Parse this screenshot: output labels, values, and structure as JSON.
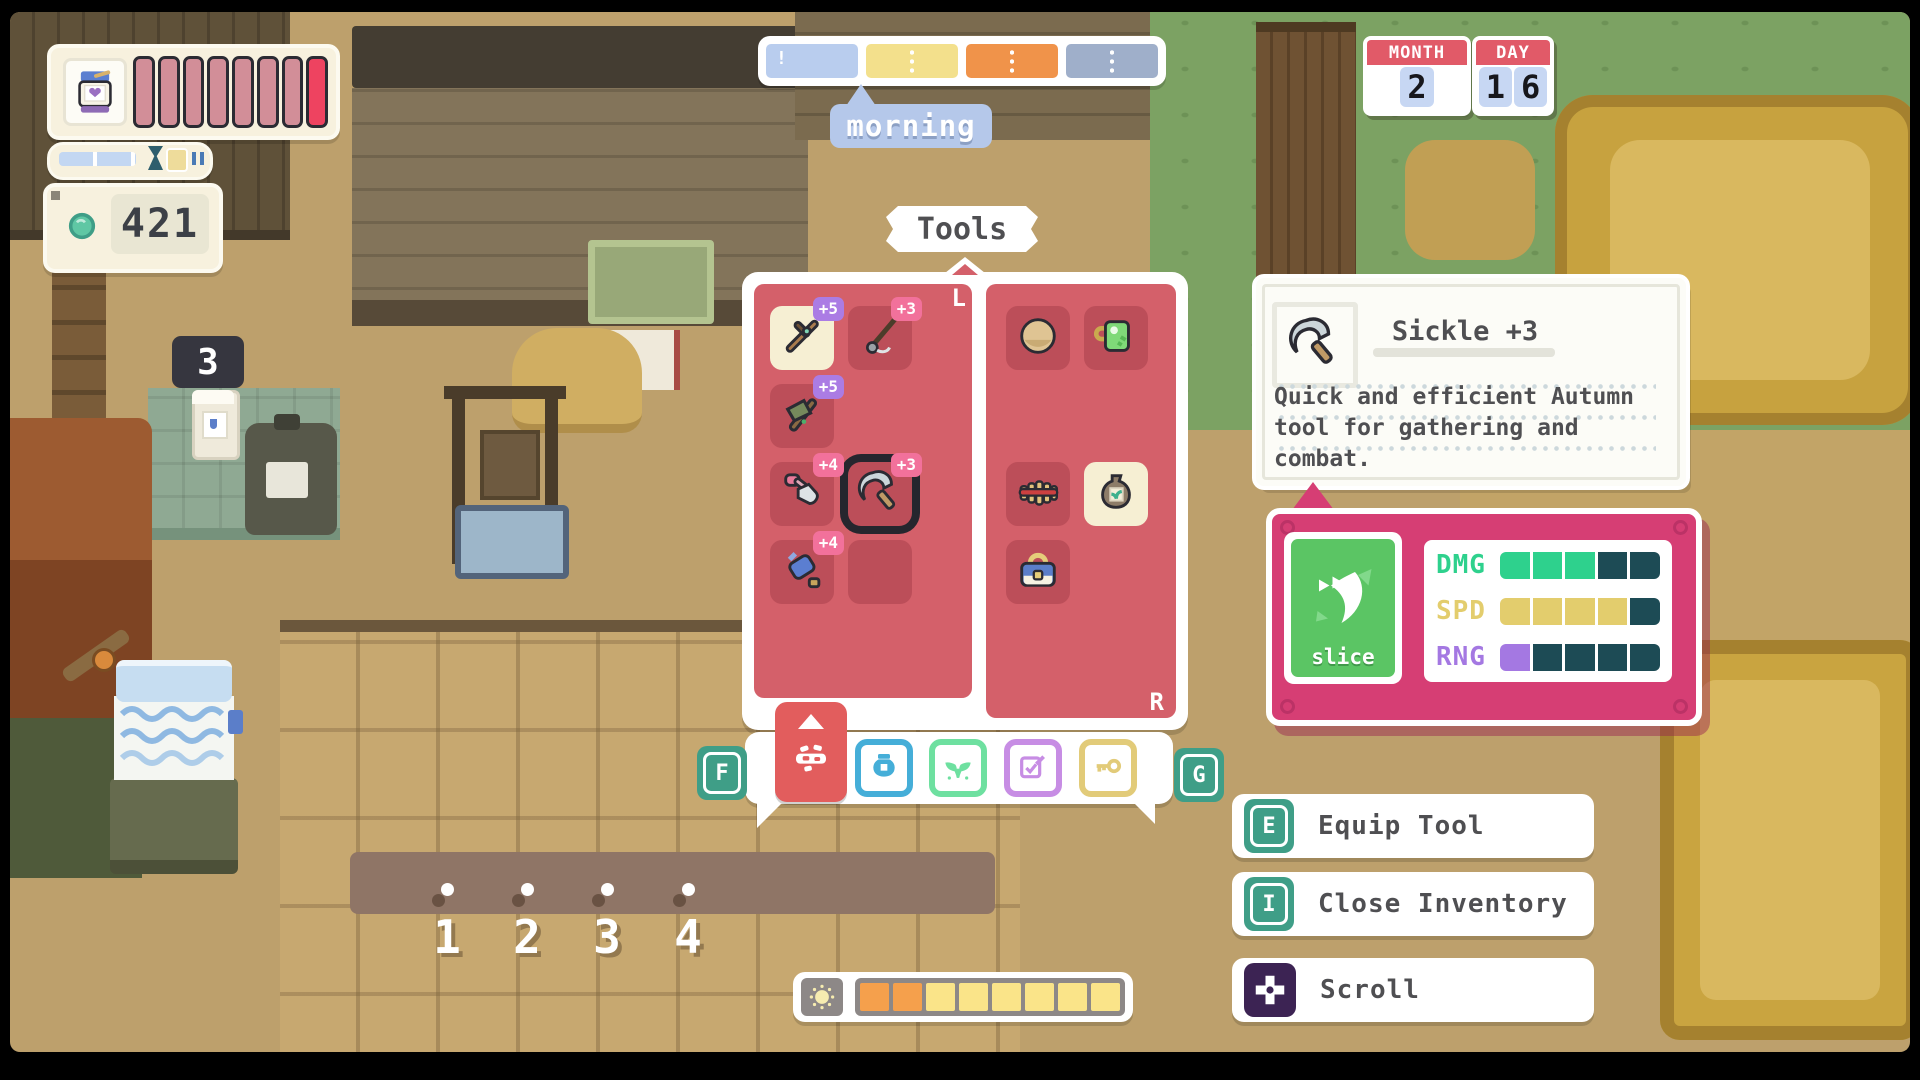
{
  "palette": {
    "panel_red": "#d4606a",
    "slot_red": "#bc4e59",
    "stats_magenta": "#d63e74",
    "card_green": "#5bc564",
    "key_teal": "#3f9e87",
    "health_dim": "#d28e98",
    "health_bright": "#ee4360"
  },
  "hud": {
    "health": {
      "total": 8,
      "dim": 7,
      "bright": 1
    },
    "xp_fill_pct": 55,
    "money": "421"
  },
  "time": {
    "label": "morning",
    "segments": [
      {
        "id": "dawn",
        "color": "#b9cdee"
      },
      {
        "id": "morning",
        "color": "#f3e08c"
      },
      {
        "id": "afternoon",
        "color": "#f0934a"
      },
      {
        "id": "night",
        "color": "#9fafca"
      }
    ]
  },
  "calendar": {
    "month_label": "MONTH",
    "month_value": "2",
    "day_label": "DAY",
    "day_digits": [
      "1",
      "6"
    ]
  },
  "inventory": {
    "title": "Tools",
    "left_marker": "L",
    "right_marker": "R",
    "left_slots": [
      {
        "item": "polearm",
        "badge": "+5",
        "badge_color": "purple",
        "bg": "highlight"
      },
      {
        "item": "fishing-rod",
        "badge": "+3",
        "badge_color": "pink",
        "bg": "slot"
      },
      {
        "item": "axe",
        "badge": "+5",
        "badge_color": "purple",
        "bg": "slot"
      },
      {
        "item": null,
        "bg": "none"
      },
      {
        "item": "shovel",
        "badge": "+4",
        "badge_color": "pink",
        "bg": "slot"
      },
      {
        "item": "sickle",
        "badge": "+3",
        "badge_color": "pink",
        "bg": "slot",
        "selected": true
      },
      {
        "item": "watering-can",
        "badge": "+4",
        "badge_color": "pink",
        "bg": "slot"
      },
      {
        "item": null,
        "bg": "slot"
      }
    ],
    "right_slots": [
      {
        "item": "plate",
        "bg": "slot"
      },
      {
        "item": "mug",
        "bg": "slot"
      },
      {
        "item": null,
        "bg": "none"
      },
      {
        "item": null,
        "bg": "none"
      },
      {
        "item": "panflute",
        "bg": "slot"
      },
      {
        "item": "seed-bag",
        "bg": "highlight"
      },
      {
        "item": "basket",
        "bg": "slot"
      },
      {
        "item": null,
        "bg": "none"
      }
    ]
  },
  "tabs": {
    "left_key": "F",
    "right_key": "G",
    "items": [
      {
        "id": "tools",
        "color": "#e25d5d",
        "selected": true
      },
      {
        "id": "jar",
        "color": "#45aed8",
        "selected": false
      },
      {
        "id": "sprout",
        "color": "#6ee0a0",
        "selected": false
      },
      {
        "id": "tasks",
        "color": "#c78de4",
        "selected": false
      },
      {
        "id": "key",
        "color": "#e2cb79",
        "selected": false
      }
    ]
  },
  "tooltip": {
    "title": "Sickle +3",
    "description": "Quick and efficient Autumn tool for gathering and combat."
  },
  "stats_panel": {
    "card_label": "slice",
    "rows": [
      {
        "label": "DMG",
        "filled": 3,
        "total": 5,
        "color": "#2ed18d"
      },
      {
        "label": "SPD",
        "filled": 4,
        "total": 5,
        "color": "#e3cd6d"
      },
      {
        "label": "RNG",
        "filled": 1,
        "total": 5,
        "color": "#a478e2"
      }
    ],
    "empty_cell_color": "#1d4b55"
  },
  "hints": [
    {
      "key": "E",
      "chip": "key",
      "label": "Equip Tool"
    },
    {
      "key": "I",
      "chip": "key",
      "label": "Close Inventory"
    },
    {
      "key": null,
      "chip": "dpad",
      "label": "Scroll"
    }
  ],
  "stamina": {
    "total": 8,
    "orange": 2,
    "yellow": 6,
    "orange_color": "#f5a04c",
    "yellow_color": "#fae489"
  },
  "world": {
    "sign_value": "3",
    "plot_markers": [
      "1",
      "2",
      "3",
      "4"
    ]
  }
}
